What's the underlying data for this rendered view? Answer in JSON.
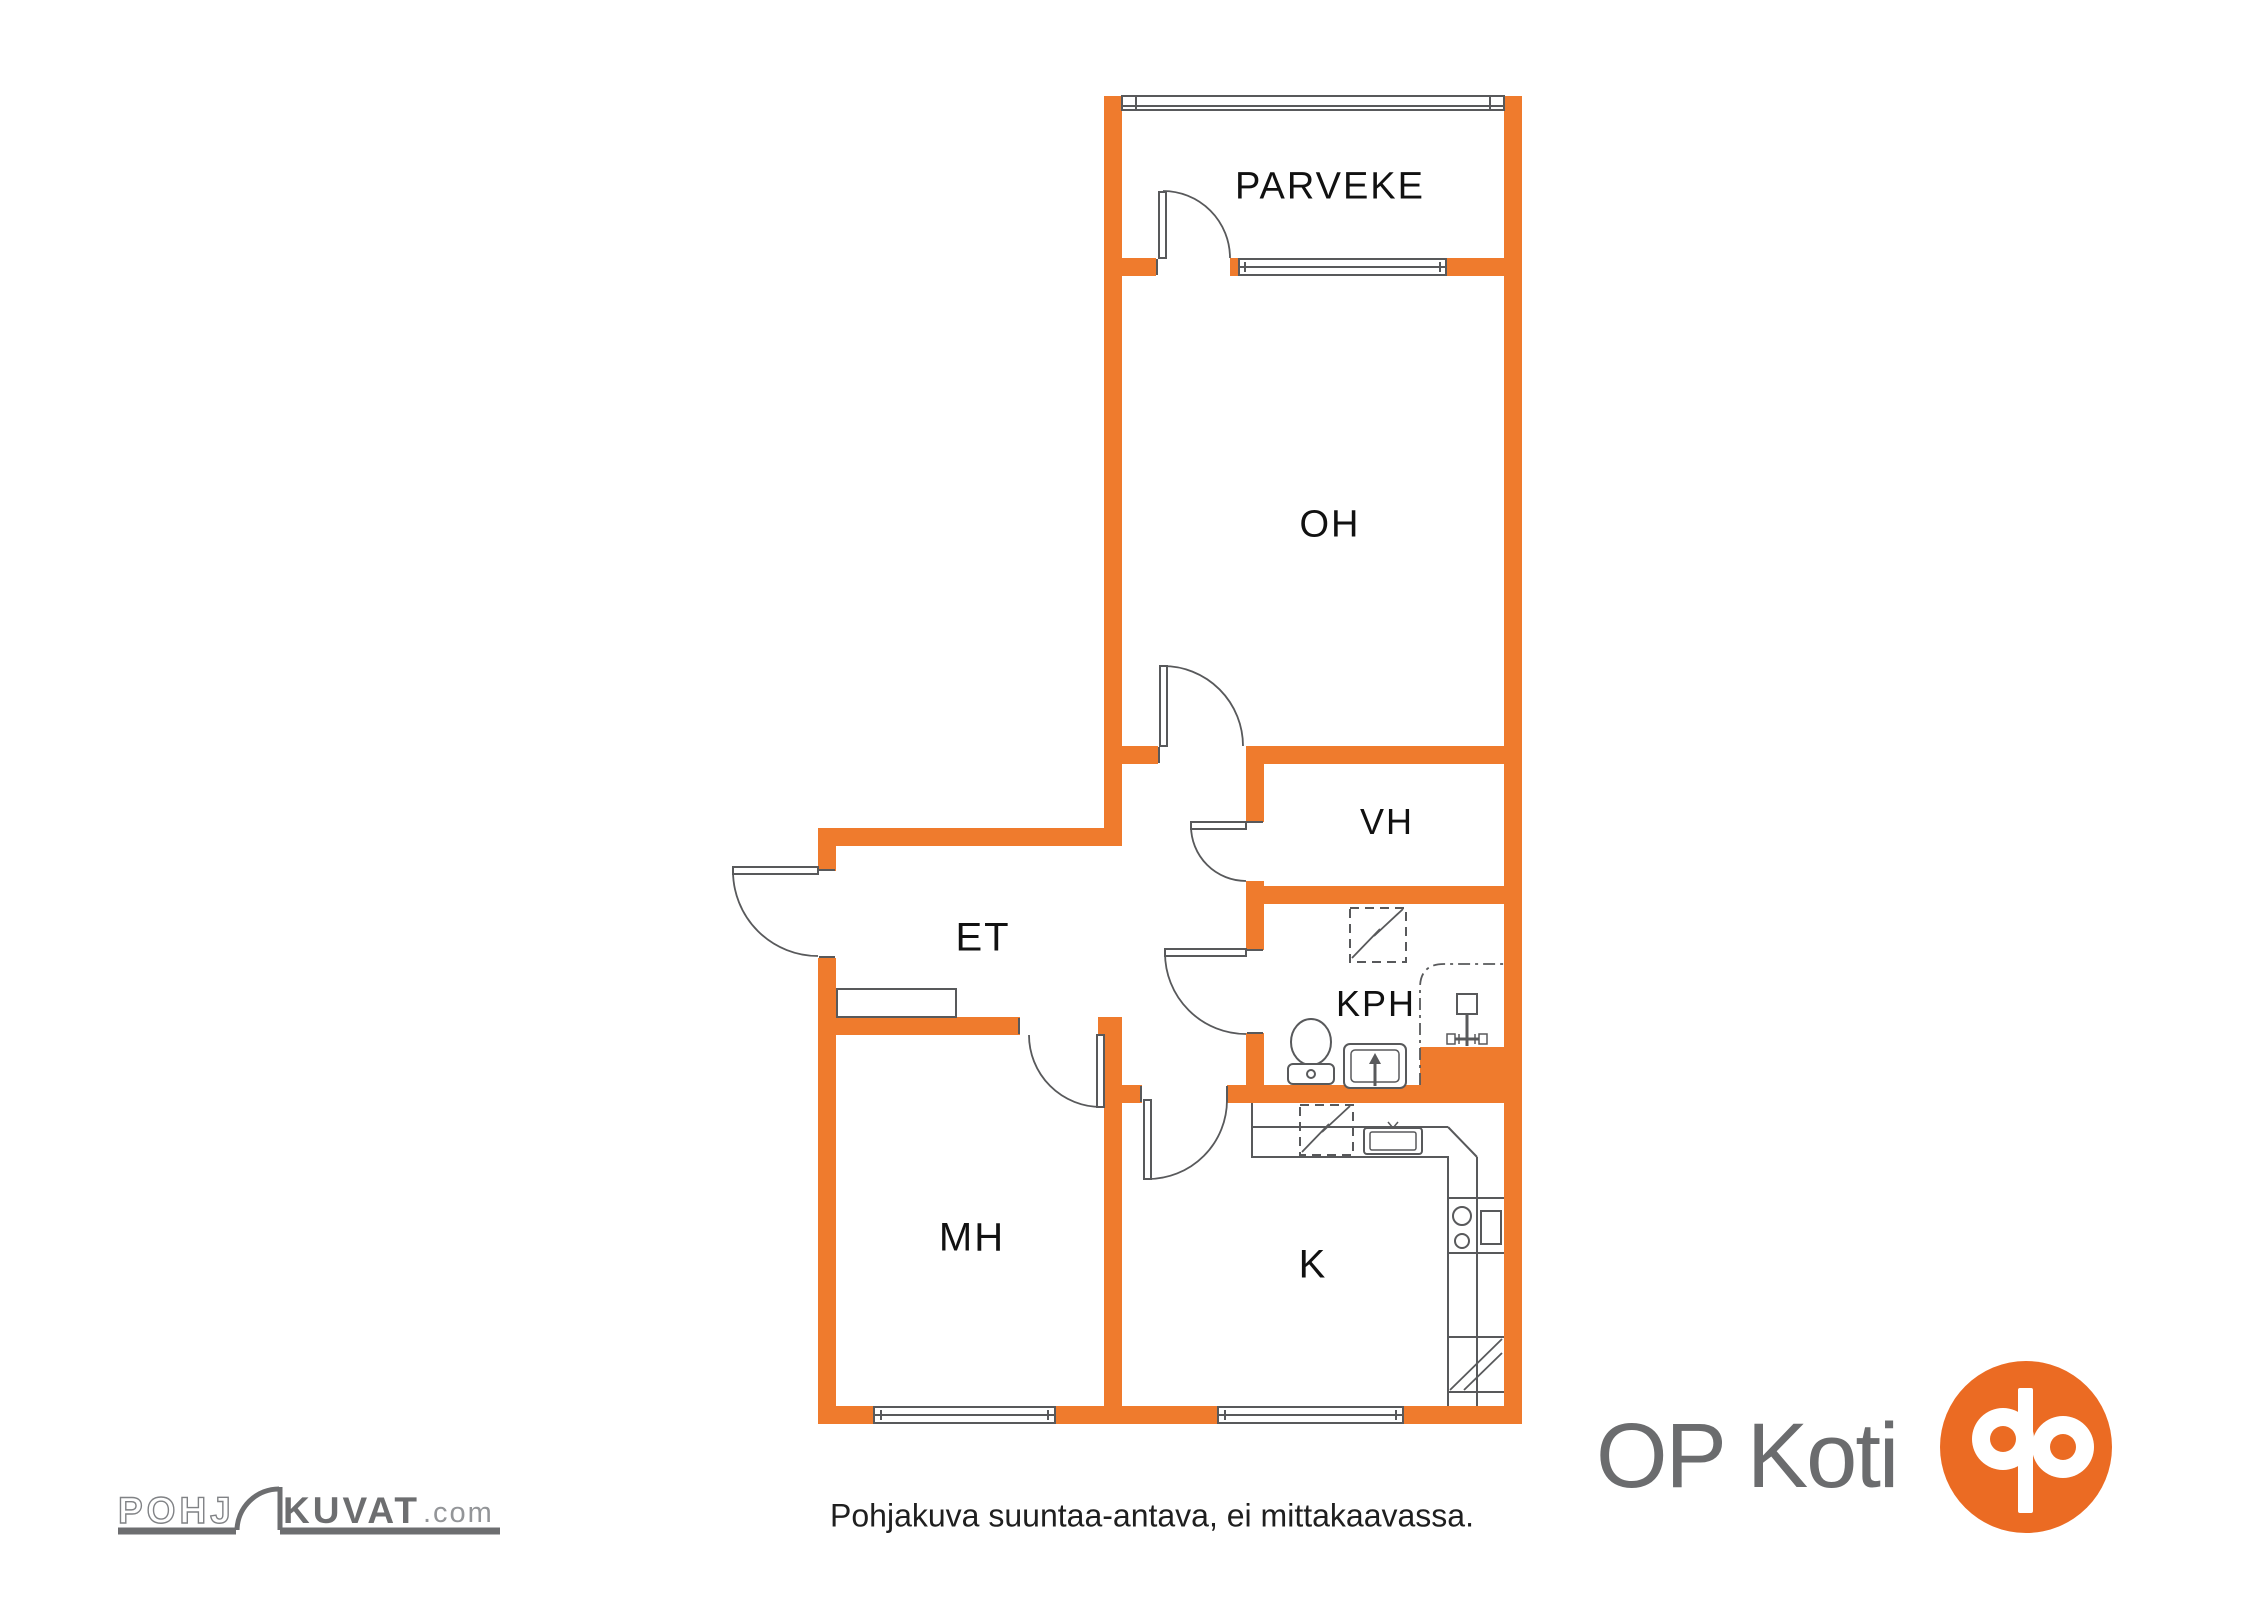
{
  "colors": {
    "wall_orange": "#EF7B2D",
    "logo_orange": "#EB6B23",
    "line_gray": "#58595B",
    "text_dark": "#111111",
    "logo_text_gray": "#6D6E70",
    "outline_letter_gray": "#808285",
    "dotcom_gray": "#939598",
    "brand_text_gray": "#6B6C6E"
  },
  "rooms": [
    {
      "id": "parveke",
      "label": "PARVEKE"
    },
    {
      "id": "oh",
      "label": "OH"
    },
    {
      "id": "vh",
      "label": "VH"
    },
    {
      "id": "et",
      "label": "ET"
    },
    {
      "id": "kph",
      "label": "KPH"
    },
    {
      "id": "mh",
      "label": "MH"
    },
    {
      "id": "k",
      "label": "K"
    }
  ],
  "footer": {
    "disclaimer": "Pohjakuva suuntaa-antava, ei mittakaavassa."
  },
  "watermark": {
    "pohj": "POHJ",
    "kuvat": "KUVAT",
    "dotcom": ".com"
  },
  "brand": {
    "name": "OP Koti"
  }
}
